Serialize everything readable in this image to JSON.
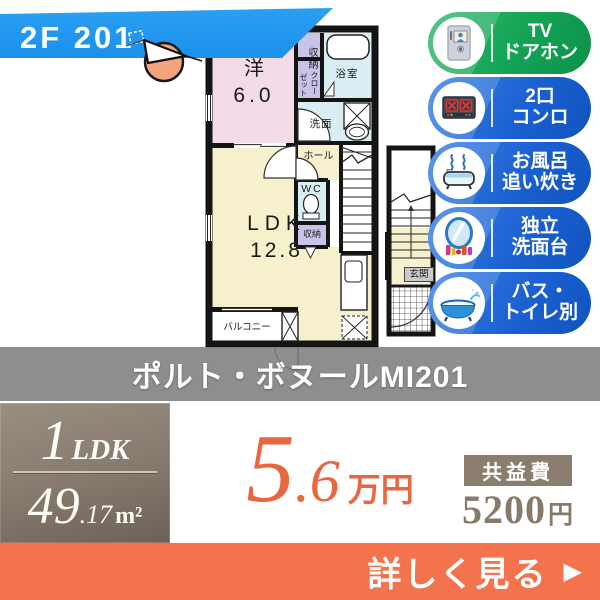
{
  "banner": {
    "unit": "2F 201"
  },
  "floorplan": {
    "western_room_label": "洋",
    "western_room_size": "6.0",
    "ldk_label": "LDK",
    "ldk_size": "12.8",
    "closet_top": "収納",
    "closet_right_col": "クロー",
    "closet_left_col": "ゼット",
    "bath": "浴室",
    "washroom": "洗面",
    "hall": "ホール",
    "toilet": "WC",
    "storage": "収納",
    "balcony": "バルコニー",
    "entrance": "玄関"
  },
  "features": [
    {
      "line1": "TV",
      "line2": "ドアホン"
    },
    {
      "line1": "2口",
      "line2": "コンロ"
    },
    {
      "line1": "お風呂",
      "line2": "追い炊き"
    },
    {
      "line1": "独立",
      "line2": "洗面台"
    },
    {
      "line1": "バス・",
      "line2": "トイレ別"
    }
  ],
  "property_name": "ポルト・ボヌールMI201",
  "summary": {
    "layout_number": "1",
    "layout_type": "LDK",
    "area_main": "49",
    "area_decimal": ".17",
    "area_unit": "m²",
    "rent_main": "5",
    "rent_decimal": ".6",
    "rent_unit": "万円",
    "fee_label": "共益費",
    "fee_value": "5200",
    "fee_unit": "円"
  },
  "cta": {
    "label": "詳しく見る",
    "arrow": "▶"
  },
  "colors": {
    "banner_blue": "#2196f3",
    "badge_green": "#12a254",
    "badge_blue": "#1a5fd0",
    "accent_orange": "#e96740",
    "bar_orange": "#f3744c",
    "band_gray": "#7e7e7e",
    "box_brown": "#887b6f"
  }
}
